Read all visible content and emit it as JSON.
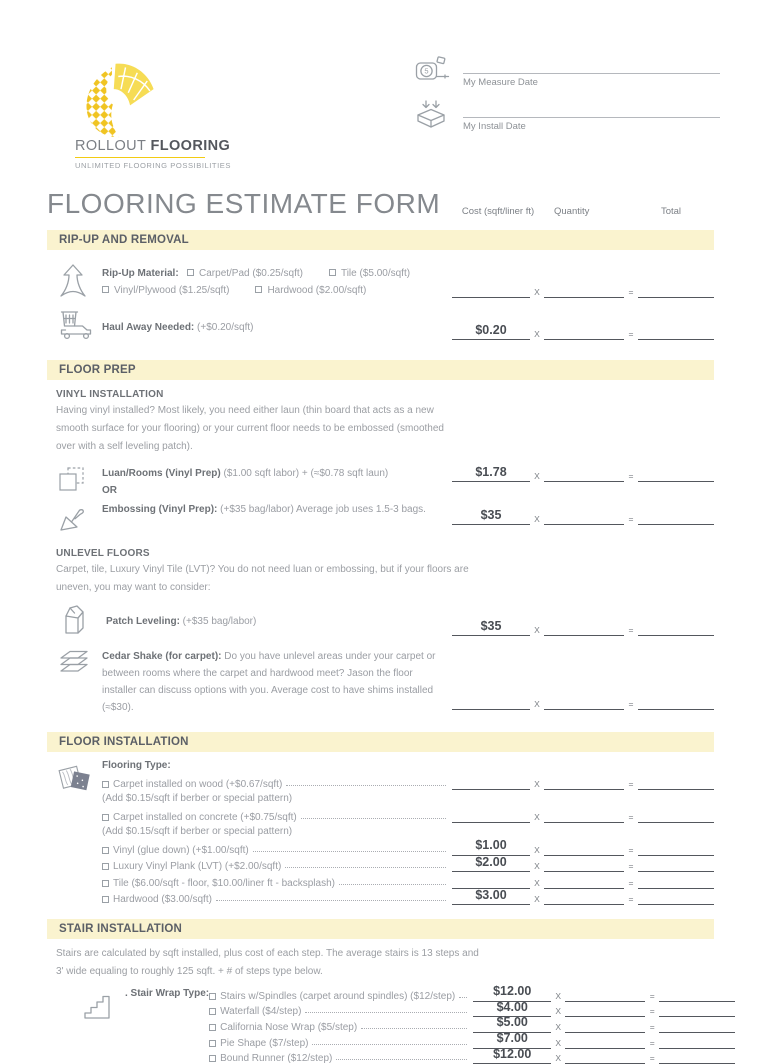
{
  "brand": {
    "name_light": "ROLLOUT ",
    "name_bold": "FLOORING",
    "tagline": "UNLIMITED FLOORING POSSIBILITIES"
  },
  "dates": {
    "measure": "My Measure Date",
    "install": "My Install Date"
  },
  "title": "FLOORING ESTIMATE FORM",
  "columns": {
    "cost": "Cost (sqft/liner ft)",
    "quantity": "Quantity",
    "total": "Total"
  },
  "calc": {
    "multiply": "X",
    "equals": "="
  },
  "ripup": {
    "heading": "RIP-UP AND REMOVAL",
    "material_label": "Rip-Up Material:",
    "material_options": [
      "Carpet/Pad ($0.25/sqft)",
      "Tile ($5.00/sqft)",
      "Vinyl/Plywood ($1.25/sqft)",
      "Hardwood ($2.00/sqft)"
    ],
    "material_cost": "",
    "haul_label": "Haul Away Needed:",
    "haul_detail": " (+$0.20/sqft)",
    "haul_cost": "$0.20"
  },
  "floor_prep": {
    "heading": "FLOOR PREP",
    "vinyl": {
      "subheading": "VINYL INSTALLATION",
      "paragraph": "Having vinyl installed? Most likely, you need either laun (thin board that acts as a new smooth surface for your flooring) or your current floor needs to be embossed (smoothed over with a self leveling patch).",
      "luan_label": "Luan/Rooms (Vinyl Prep)",
      "luan_detail": " ($1.00 sqft labor) + (≈$0.78 sqft laun)",
      "luan_cost": "$1.78",
      "or": "OR",
      "embossing_label": "Embossing (Vinyl Prep):",
      "embossing_detail": " (+$35 bag/labor) Average job uses 1.5-3 bags.",
      "embossing_cost": "$35"
    },
    "unlevel": {
      "subheading": "UNLEVEL FLOORS",
      "paragraph": "Carpet, tile, Luxury Vinyl Tile (LVT)? You do not need luan or embossing, but if your floors are uneven, you may want to consider:",
      "patch_label": "Patch Leveling:",
      "patch_detail": " (+$35 bag/labor)",
      "patch_cost": "$35",
      "cedar_label": "Cedar Shake (for carpet):",
      "cedar_detail": " Do you have unlevel areas under your carpet or between rooms where the carpet and hardwood meet? Jason the floor installer can discuss options with you. Average cost to have shims installed (≈$30).",
      "cedar_cost": ""
    }
  },
  "floor_install": {
    "heading": "FLOOR INSTALLATION",
    "type_label": "Flooring Type:",
    "options": [
      {
        "label": "Carpet installed on wood (+$0.67/sqft)",
        "cost": "",
        "note": "(Add $0.15/sqft if berber or special pattern)"
      },
      {
        "label": "Carpet installed on concrete  (+$0.75/sqft)",
        "cost": "",
        "note": "(Add $0.15/sqft if berber or special pattern)"
      },
      {
        "label": "Vinyl (glue down) (+$1.00/sqft)",
        "cost": "$1.00"
      },
      {
        "label": "Luxury Vinyl Plank (LVT) (+$2.00/sqft)",
        "cost": "$2.00"
      },
      {
        "label": "Tile ($6.00/sqft - floor,  $10.00/liner ft - backsplash)",
        "cost": ""
      },
      {
        "label": "Hardwood ($3.00/sqft)",
        "cost": "$3.00"
      }
    ]
  },
  "stairs": {
    "heading": "STAIR INSTALLATION",
    "paragraph": "Stairs are calculated by sqft installed, plus cost of each step. The average stairs is 13 steps and 3' wide equaling to roughly 125 sqft. + # of steps type below.",
    "wrap_label": ". Stair Wrap Type:",
    "options": [
      {
        "label": "Stairs w/Spindles (carpet around spindles) ($12/step)",
        "cost": "$12.00"
      },
      {
        "label": "Waterfall ($4/step)",
        "cost": "$4.00"
      },
      {
        "label": "California Nose Wrap ($5/step)",
        "cost": "$5.00"
      },
      {
        "label": "Pie Shape ($7/step)",
        "cost": "$7.00"
      },
      {
        "label": "Bound Runner ($12/step)",
        "cost": "$12.00"
      }
    ]
  },
  "colors": {
    "band": "#FAF3CF",
    "accent_yellow": "#F2CB13",
    "heading_text": "#5B5F66",
    "body_text": "#9A9DA3",
    "line": "#54575D"
  }
}
